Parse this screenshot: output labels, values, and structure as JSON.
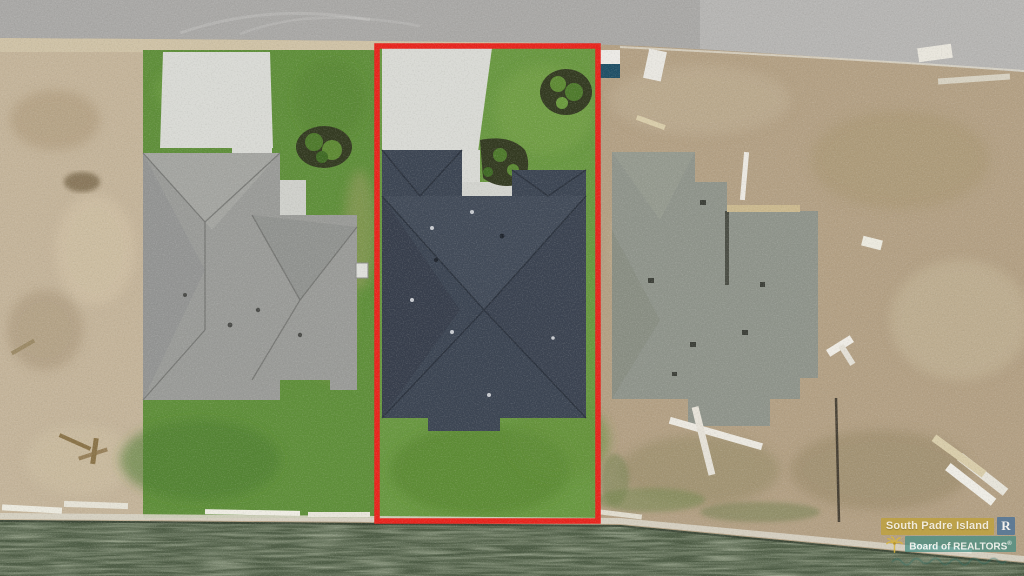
{
  "watermark": {
    "line1": "South Padre Island",
    "line2": "Board of REALTORS",
    "registered_mark": "®",
    "realtor_logo_letter": "R",
    "palm_icon": "palm-tree-icon",
    "tagline_legible": false
  },
  "highlight": {
    "type": "property-boundary-outline",
    "shape": "rectangle",
    "color": "#e8241d"
  },
  "scene_labels": {
    "road": "street at top",
    "left_house": "finished house with gray shingle roof",
    "middle_house": "featured house with dark charcoal-blue shingle roof inside red outline",
    "right_house": "house under construction on bare dirt lot",
    "water": "canal along bottom edge",
    "seawall": "concrete bulkhead at waterline"
  },
  "colors": {
    "outline-red": "#e8241d",
    "road": "#a9a8a6",
    "road-light": "#b9b8b6",
    "sand": "#cfc2a6",
    "dirt-left": "#c4b49a",
    "dirt-right": "#b3a084",
    "grass": "#5f8f3a",
    "grass-mid": "#699841",
    "grass-dark": "#4e7c30",
    "concrete": "#d9dad5",
    "roof-left": "#9a9b98",
    "roof-mid": "#3c4553",
    "roof-right": "#8f948b",
    "water": "#4d5c45",
    "seawall": "#d8d4c6",
    "wm-gold": "#c1a22c",
    "wm-teal": "#3e8b81",
    "wm-blue": "#3a6a9b",
    "mulch": "#333a21"
  }
}
